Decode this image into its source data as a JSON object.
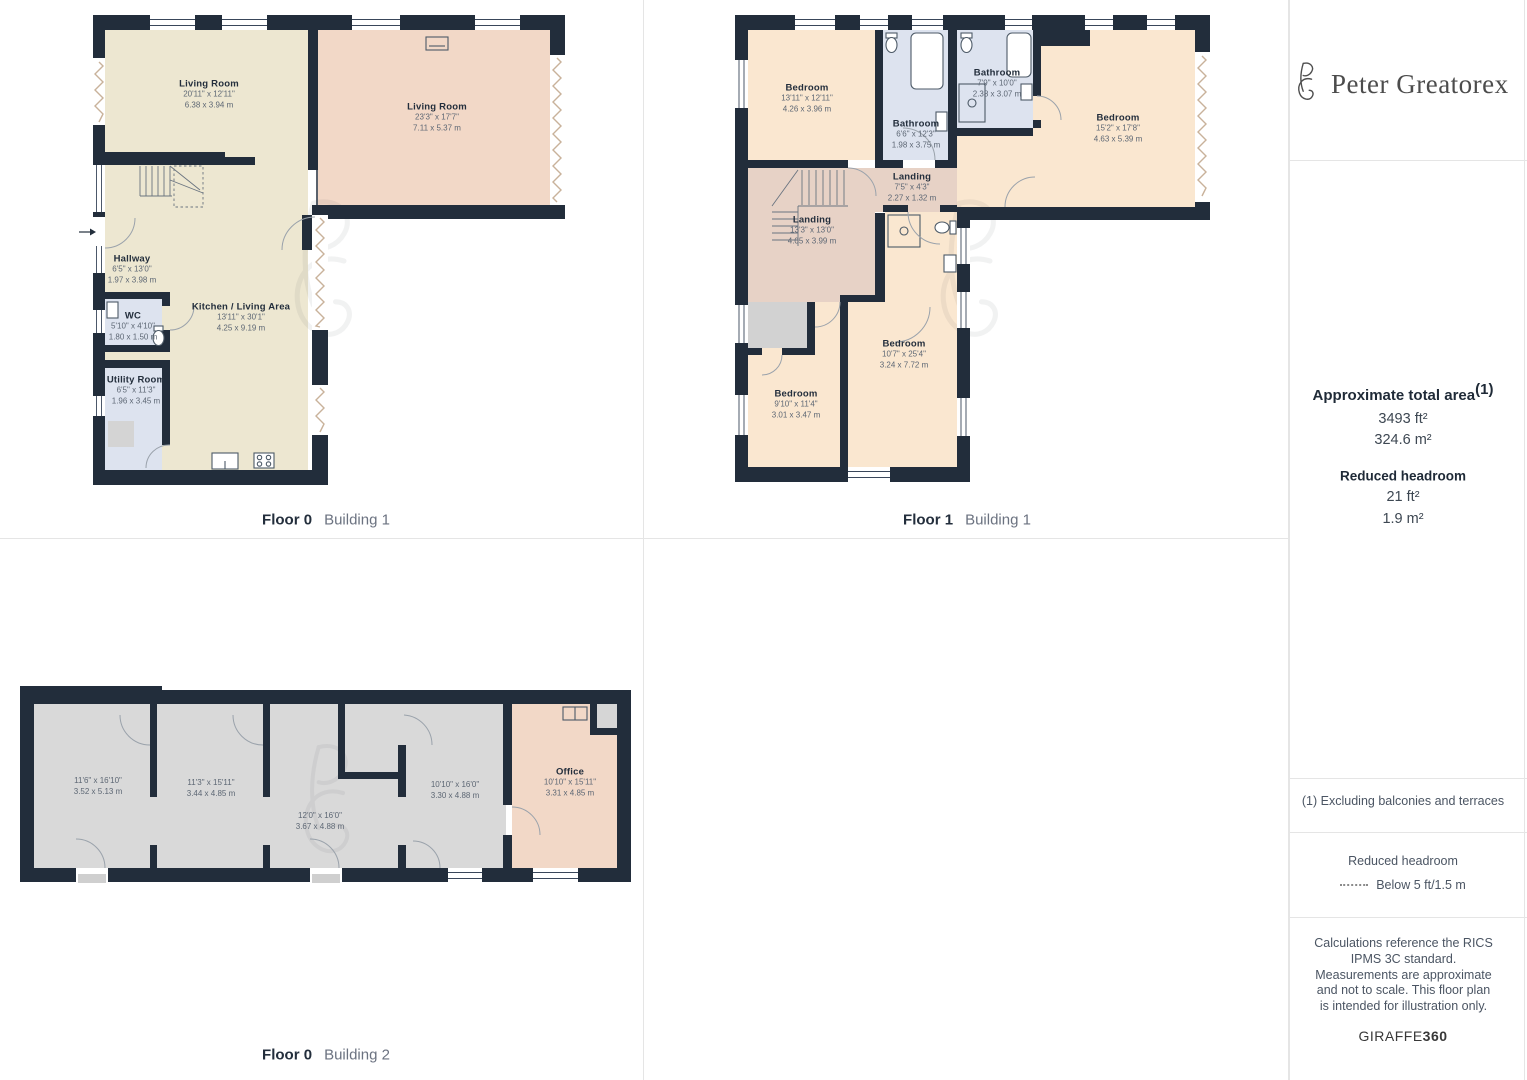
{
  "brand": {
    "name": "Peter Greatorex",
    "monogram": "PG"
  },
  "sidebar": {
    "total_area": {
      "title": "Approximate total area",
      "superscript": "(1)",
      "imperial": "3493 ft²",
      "metric": "324.6 m²"
    },
    "reduced_headroom": {
      "title": "Reduced headroom",
      "imperial": "21 ft²",
      "metric": "1.9 m²"
    },
    "footnote": "(1) Excluding balconies and terraces",
    "legend": {
      "title": "Reduced headroom",
      "label": "Below 5 ft/1.5 m"
    },
    "disclaimer": "Calculations reference the RICS IPMS 3C standard. Measurements are approximate and not to scale. This floor plan is intended for illustration only.",
    "credit": {
      "name": "GIRAFFE",
      "suffix": "360"
    }
  },
  "plans": [
    {
      "floor": "Floor 0",
      "building": "Building 1",
      "rooms": [
        {
          "name": "Living Room",
          "imperial": "20'11\" x 12'11\"",
          "metric": "6.38 x 3.94 m"
        },
        {
          "name": "Living Room",
          "imperial": "23'3\" x 17'7\"",
          "metric": "7.11 x 5.37 m"
        },
        {
          "name": "Hallway",
          "imperial": "6'5\" x 13'0\"",
          "metric": "1.97 x 3.98 m"
        },
        {
          "name": "WC",
          "imperial": "5'10\" x 4'10\"",
          "metric": "1.80 x 1.50 m"
        },
        {
          "name": "Kitchen / Living Area",
          "imperial": "13'11\" x 30'1\"",
          "metric": "4.25 x 9.19 m"
        },
        {
          "name": "Utility Room",
          "imperial": "6'5\" x 11'3\"",
          "metric": "1.96 x 3.45 m"
        }
      ]
    },
    {
      "floor": "Floor 1",
      "building": "Building 1",
      "rooms": [
        {
          "name": "Bedroom",
          "imperial": "13'11\" x 12'11\"",
          "metric": "4.26 x 3.96 m"
        },
        {
          "name": "Bathroom",
          "imperial": "7'9\" x 10'0\"",
          "metric": "2.38 x 3.07 m"
        },
        {
          "name": "Bathroom",
          "imperial": "6'6\" x 12'3\"",
          "metric": "1.98 x 3.75 m"
        },
        {
          "name": "Bedroom",
          "imperial": "15'2\" x 17'8\"",
          "metric": "4.63 x 5.39 m"
        },
        {
          "name": "Landing",
          "imperial": "7'5\" x 4'3\"",
          "metric": "2.27 x 1.32 m"
        },
        {
          "name": "Landing",
          "imperial": "13'3\" x 13'0\"",
          "metric": "4.05 x 3.99 m"
        },
        {
          "name": "Bedroom",
          "imperial": "10'7\" x 25'4\"",
          "metric": "3.24 x 7.72 m"
        },
        {
          "name": "Bedroom",
          "imperial": "9'10\" x 11'4\"",
          "metric": "3.01 x 3.47 m"
        }
      ]
    },
    {
      "floor": "Floor 0",
      "building": "Building 2",
      "rooms": [
        {
          "name": "",
          "imperial": "11'6\" x 16'10\"",
          "metric": "3.52 x 5.13 m"
        },
        {
          "name": "",
          "imperial": "11'3\" x 15'11\"",
          "metric": "3.44 x 4.85 m"
        },
        {
          "name": "",
          "imperial": "12'0\" x 16'0\"",
          "metric": "3.67 x 4.88 m"
        },
        {
          "name": "",
          "imperial": "10'10\" x 16'0\"",
          "metric": "3.30 x 4.88 m"
        },
        {
          "name": "Office",
          "imperial": "10'10\" x 15'11\"",
          "metric": "3.31 x 4.85 m"
        }
      ]
    }
  ],
  "colors": {
    "wall": "#222d3b",
    "room_beige": "#ede7d1",
    "room_salmon": "#f2d8c7",
    "room_peach": "#fae7d0",
    "room_blue": "#dde3ef",
    "room_mauve": "#e7d2c6",
    "room_gray": "#d9d9d9"
  }
}
